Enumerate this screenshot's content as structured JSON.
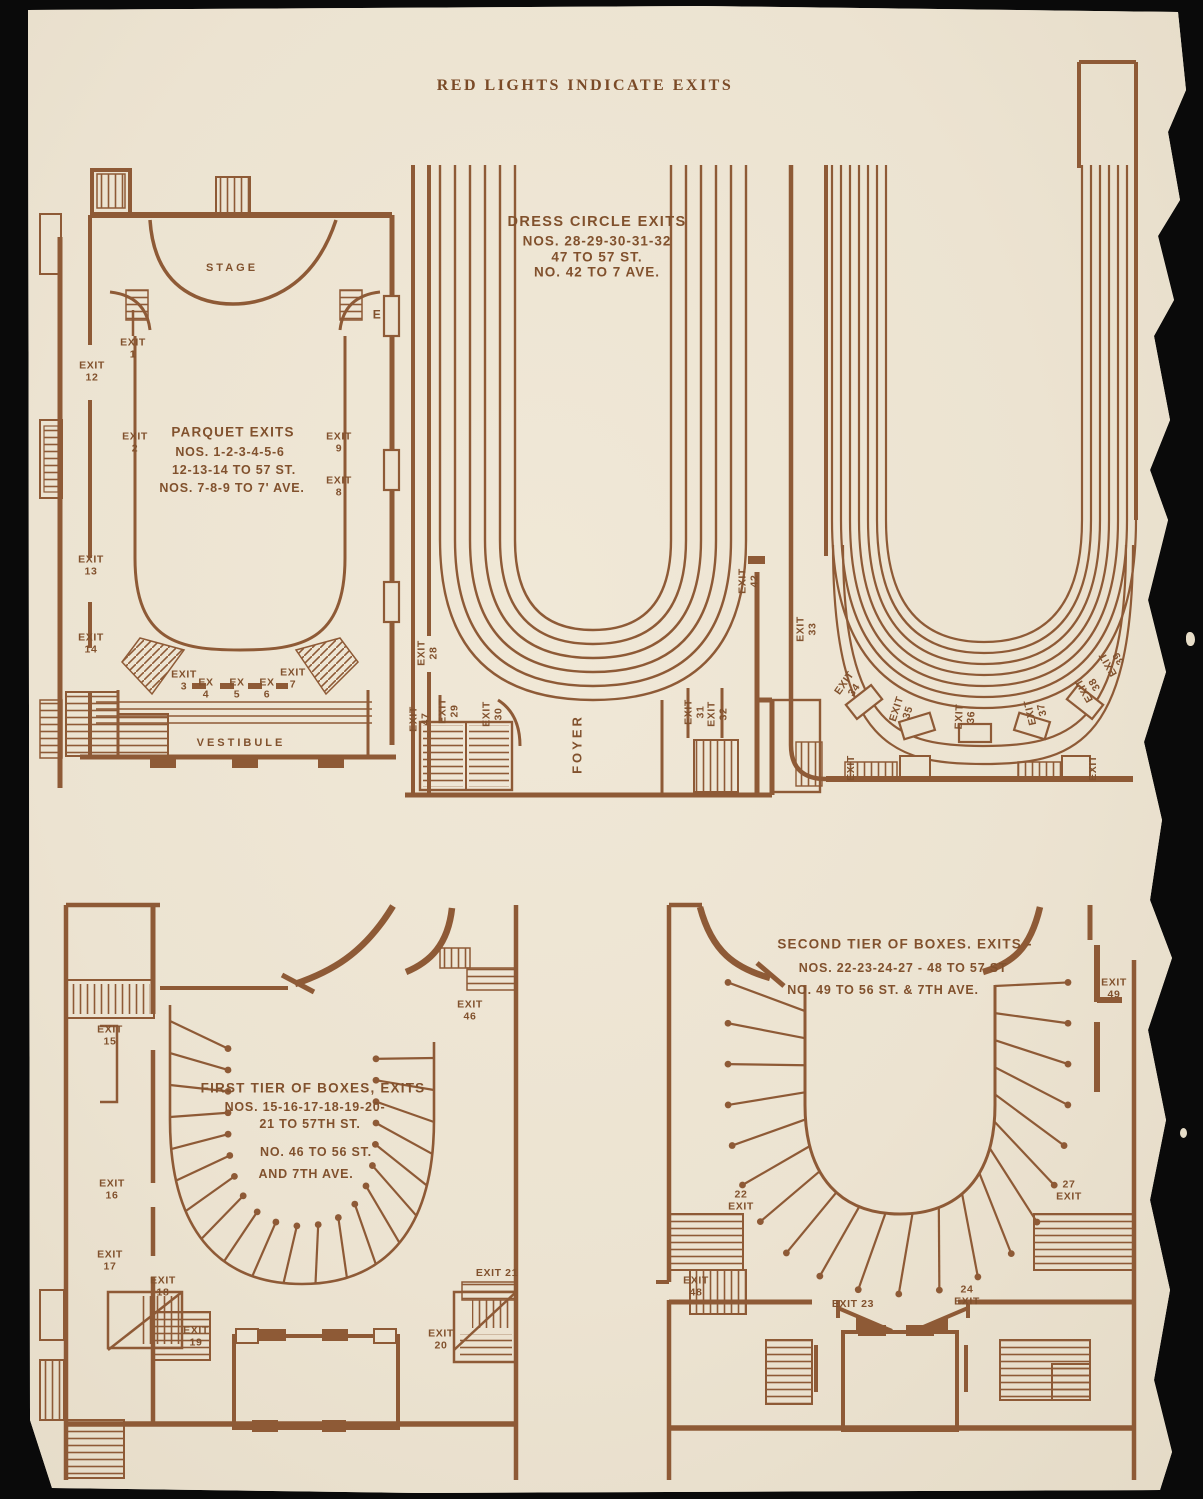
{
  "page_title": "RED LIGHTS INDICATE EXITS",
  "colors": {
    "ink": "#8e5a36",
    "text": "#81512d",
    "paper": "#ece3d1",
    "background": "#0a0a0a"
  },
  "plans": {
    "parquet": {
      "stage": "STAGE",
      "vestibule": "VESTIBULE",
      "door": "E",
      "note": [
        "PARQUET EXITS",
        "NOS. 1-2-3-4-5-6",
        "12-13-14 TO 57 ST.",
        "NOS. 7-8-9 TO 7' AVE."
      ],
      "exits": {
        "e12": "EXIT\n12",
        "e1": "EXIT\n1",
        "e2": "EXIT\n2",
        "e9": "EXIT\n9",
        "e8": "EXIT\n8",
        "e13": "EXIT\n13",
        "e14": "EXIT\n14",
        "e3": "EXIT\n3",
        "e4": "EX\n4",
        "e5": "EX\n5",
        "e6": "EX\n6",
        "e7": "EXIT\n7"
      }
    },
    "dress_circle": {
      "note": [
        "DRESS CIRCLE EXITS",
        "NOS. 28-29-30-31-32",
        "47 TO 57 ST.",
        "NO. 42 TO 7 AVE."
      ],
      "foyer": "FOYER",
      "exits": {
        "e28": "EXIT\n28",
        "e47": "EXIT\n47",
        "e29": "EXIT\n29",
        "e30": "EXIT\n30",
        "e42": "EXIT\n42",
        "e31": "EXIT\n31",
        "e32": "EXIT\n32"
      }
    },
    "balcony": {
      "exits": {
        "e33": "EXIT\n33",
        "e34": "EXIT\n34",
        "e35": "EXIT\n35",
        "e36": "EXIT\n36",
        "e37": "EXIT\n37",
        "e38": "EXIT\n38",
        "e39": "EXIT\n39",
        "eL": "EXIT",
        "eR": "EXIT"
      }
    },
    "first_tier": {
      "note": [
        "FIRST TIER OF BOXES, EXITS",
        "NOS. 15-16-17-18-19-20-",
        "21 TO 57TH ST.",
        "NO. 46 TO 56 ST.",
        "AND 7TH AVE."
      ],
      "exits": {
        "e15": "EXIT\n15",
        "e46": "EXIT\n46",
        "e16": "EXIT\n16",
        "e17": "EXIT\n17",
        "e18": "EXIT\n18",
        "e19": "EXIT\n19",
        "e21": "EXIT 21",
        "e20": "EXIT\n20"
      }
    },
    "second_tier": {
      "note": [
        "SECOND TIER OF BOXES. EXITS -",
        "NOS. 22-23-24-27 - 48 TO 57 ST",
        "NO. 49 TO 56 ST. & 7TH AVE."
      ],
      "exits": {
        "e49": "EXIT\n49",
        "e22": "22\nEXIT",
        "e27": "27\nEXIT",
        "e48": "EXIT\n48",
        "e23": "EXIT 23",
        "e24": "24\nEXIT"
      }
    }
  }
}
